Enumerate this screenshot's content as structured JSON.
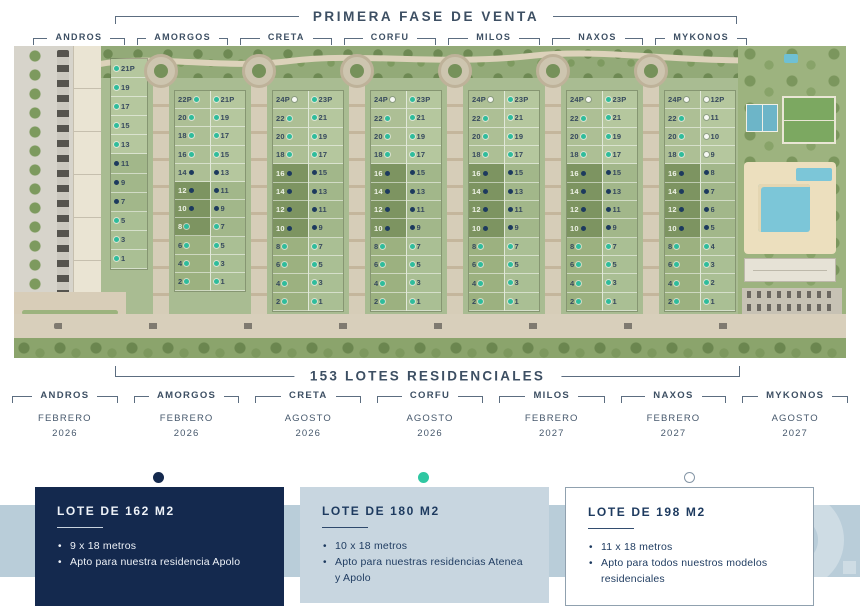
{
  "title": "PRIMERA FASE DE VENTA",
  "lots_label": "153 LOTES RESIDENCIALES",
  "map": {
    "block_labels": [
      "ANDROS",
      "AMORGOS",
      "CRETA",
      "CORFU",
      "MILOS",
      "NAXOS",
      "MYKONOS"
    ],
    "strips": [
      {
        "id": "strip-1",
        "cols": [
          {
            "dot": "left",
            "lots": [
              [
                "21P",
                "t"
              ],
              [
                "19",
                "t"
              ],
              [
                "17",
                "t"
              ],
              [
                "15",
                "t"
              ],
              [
                "13",
                "t"
              ],
              [
                "11",
                "n"
              ],
              [
                "9",
                "n"
              ],
              [
                "7",
                "n"
              ],
              [
                "5",
                "t"
              ],
              [
                "3",
                "t"
              ],
              [
                "1",
                "t"
              ]
            ]
          }
        ]
      },
      {
        "id": "strip-2",
        "cols": [
          {
            "dot": "right",
            "lots": [
              [
                "22P",
                "t"
              ],
              [
                "20",
                "t"
              ],
              [
                "18",
                "t"
              ],
              [
                "16",
                "t"
              ],
              [
                "14",
                "n"
              ],
              [
                "12",
                "n"
              ],
              [
                "10",
                "n"
              ],
              [
                "8",
                "t"
              ],
              [
                "6",
                "t"
              ],
              [
                "4",
                "t"
              ],
              [
                "2",
                "t"
              ]
            ]
          },
          {
            "dot": "left",
            "lots": [
              [
                "21P",
                "t"
              ],
              [
                "19",
                "t"
              ],
              [
                "17",
                "t"
              ],
              [
                "15",
                "t"
              ],
              [
                "13",
                "n"
              ],
              [
                "11",
                "n"
              ],
              [
                "9",
                "n"
              ],
              [
                "7",
                "t"
              ],
              [
                "5",
                "t"
              ],
              [
                "3",
                "t"
              ],
              [
                "1",
                "t"
              ]
            ]
          }
        ]
      },
      {
        "id": "strip-3",
        "cols": [
          {
            "dot": "right",
            "lots": [
              [
                "24P",
                "w"
              ],
              [
                "22",
                "t"
              ],
              [
                "20",
                "t"
              ],
              [
                "18",
                "t"
              ],
              [
                "16",
                "n"
              ],
              [
                "14",
                "n"
              ],
              [
                "12",
                "n"
              ],
              [
                "10",
                "n"
              ],
              [
                "8",
                "t"
              ],
              [
                "6",
                "t"
              ],
              [
                "4",
                "t"
              ],
              [
                "2",
                "t"
              ]
            ]
          },
          {
            "dot": "left",
            "lots": [
              [
                "23P",
                "t"
              ],
              [
                "21",
                "t"
              ],
              [
                "19",
                "t"
              ],
              [
                "17",
                "t"
              ],
              [
                "15",
                "n"
              ],
              [
                "13",
                "n"
              ],
              [
                "11",
                "n"
              ],
              [
                "9",
                "n"
              ],
              [
                "7",
                "t"
              ],
              [
                "5",
                "t"
              ],
              [
                "3",
                "t"
              ],
              [
                "1",
                "t"
              ]
            ]
          }
        ]
      },
      {
        "id": "strip-4",
        "cols": [
          {
            "dot": "right",
            "lots": [
              [
                "24P",
                "w"
              ],
              [
                "22",
                "t"
              ],
              [
                "20",
                "t"
              ],
              [
                "18",
                "t"
              ],
              [
                "16",
                "n"
              ],
              [
                "14",
                "n"
              ],
              [
                "12",
                "n"
              ],
              [
                "10",
                "n"
              ],
              [
                "8",
                "t"
              ],
              [
                "6",
                "t"
              ],
              [
                "4",
                "t"
              ],
              [
                "2",
                "t"
              ]
            ]
          },
          {
            "dot": "left",
            "lots": [
              [
                "23P",
                "t"
              ],
              [
                "21",
                "t"
              ],
              [
                "19",
                "t"
              ],
              [
                "17",
                "t"
              ],
              [
                "15",
                "n"
              ],
              [
                "13",
                "n"
              ],
              [
                "11",
                "n"
              ],
              [
                "9",
                "n"
              ],
              [
                "7",
                "t"
              ],
              [
                "5",
                "t"
              ],
              [
                "3",
                "t"
              ],
              [
                "1",
                "t"
              ]
            ]
          }
        ]
      },
      {
        "id": "strip-5",
        "cols": [
          {
            "dot": "right",
            "lots": [
              [
                "24P",
                "w"
              ],
              [
                "22",
                "t"
              ],
              [
                "20",
                "t"
              ],
              [
                "18",
                "t"
              ],
              [
                "16",
                "n"
              ],
              [
                "14",
                "n"
              ],
              [
                "12",
                "n"
              ],
              [
                "10",
                "n"
              ],
              [
                "8",
                "t"
              ],
              [
                "6",
                "t"
              ],
              [
                "4",
                "t"
              ],
              [
                "2",
                "t"
              ]
            ]
          },
          {
            "dot": "left",
            "lots": [
              [
                "23P",
                "t"
              ],
              [
                "21",
                "t"
              ],
              [
                "19",
                "t"
              ],
              [
                "17",
                "t"
              ],
              [
                "15",
                "n"
              ],
              [
                "13",
                "n"
              ],
              [
                "11",
                "n"
              ],
              [
                "9",
                "n"
              ],
              [
                "7",
                "t"
              ],
              [
                "5",
                "t"
              ],
              [
                "3",
                "t"
              ],
              [
                "1",
                "t"
              ]
            ]
          }
        ]
      },
      {
        "id": "strip-6",
        "cols": [
          {
            "dot": "right",
            "lots": [
              [
                "24P",
                "w"
              ],
              [
                "22",
                "t"
              ],
              [
                "20",
                "t"
              ],
              [
                "18",
                "t"
              ],
              [
                "16",
                "n"
              ],
              [
                "14",
                "n"
              ],
              [
                "12",
                "n"
              ],
              [
                "10",
                "n"
              ],
              [
                "8",
                "t"
              ],
              [
                "6",
                "t"
              ],
              [
                "4",
                "t"
              ],
              [
                "2",
                "t"
              ]
            ]
          },
          {
            "dot": "left",
            "lots": [
              [
                "23P",
                "t"
              ],
              [
                "21",
                "t"
              ],
              [
                "19",
                "t"
              ],
              [
                "17",
                "t"
              ],
              [
                "15",
                "n"
              ],
              [
                "13",
                "n"
              ],
              [
                "11",
                "n"
              ],
              [
                "9",
                "n"
              ],
              [
                "7",
                "t"
              ],
              [
                "5",
                "t"
              ],
              [
                "3",
                "t"
              ],
              [
                "1",
                "t"
              ]
            ]
          }
        ]
      },
      {
        "id": "strip-7",
        "cols": [
          {
            "dot": "right",
            "lots": [
              [
                "24P",
                "w"
              ],
              [
                "22",
                "t"
              ],
              [
                "20",
                "t"
              ],
              [
                "18",
                "t"
              ],
              [
                "16",
                "n"
              ],
              [
                "14",
                "n"
              ],
              [
                "12",
                "n"
              ],
              [
                "10",
                "n"
              ],
              [
                "8",
                "t"
              ],
              [
                "6",
                "t"
              ],
              [
                "4",
                "t"
              ],
              [
                "2",
                "t"
              ]
            ]
          },
          {
            "dot": "left",
            "lots": [
              [
                "12P",
                "w"
              ],
              [
                "11",
                "w"
              ],
              [
                "10",
                "w"
              ],
              [
                "9",
                "w"
              ],
              [
                "8",
                "n"
              ],
              [
                "7",
                "n"
              ],
              [
                "6",
                "n"
              ],
              [
                "5",
                "n"
              ],
              [
                "4",
                "t"
              ],
              [
                "3",
                "t"
              ],
              [
                "2",
                "t"
              ],
              [
                "1",
                "t"
              ]
            ]
          }
        ]
      }
    ]
  },
  "phases": [
    {
      "name": "ANDROS",
      "month": "FEBRERO",
      "year": "2026"
    },
    {
      "name": "AMORGOS",
      "month": "FEBRERO",
      "year": "2026"
    },
    {
      "name": "CRETA",
      "month": "AGOSTO",
      "year": "2026"
    },
    {
      "name": "CORFU",
      "month": "AGOSTO",
      "year": "2026"
    },
    {
      "name": "MILOS",
      "month": "FEBRERO",
      "year": "2027"
    },
    {
      "name": "NAXOS",
      "month": "FEBRERO",
      "year": "2027"
    },
    {
      "name": "MYKONOS",
      "month": "AGOSTO",
      "year": "2027"
    }
  ],
  "legend_cards": [
    {
      "dot": "navy",
      "title": "LOTE DE 162 M2",
      "bullets": [
        "9 x 18 metros",
        "Apto para nuestra residencia Apolo"
      ]
    },
    {
      "dot": "teal",
      "title": "LOTE DE 180 M2",
      "bullets": [
        "10 x 18 metros",
        "Apto para nuestras residencias Atenea y Apolo"
      ]
    },
    {
      "dot": "white",
      "title": "LOTE DE 198 M2",
      "bullets": [
        "11 x 18 metros",
        "Apto para todos nuestros modelos residenciales"
      ]
    }
  ],
  "colors": {
    "navy": "#14294e",
    "teal": "#2fc7a2",
    "white_lot": "#ffffff",
    "band": "#b9cdd9",
    "slate_text": "#3d4f63"
  }
}
